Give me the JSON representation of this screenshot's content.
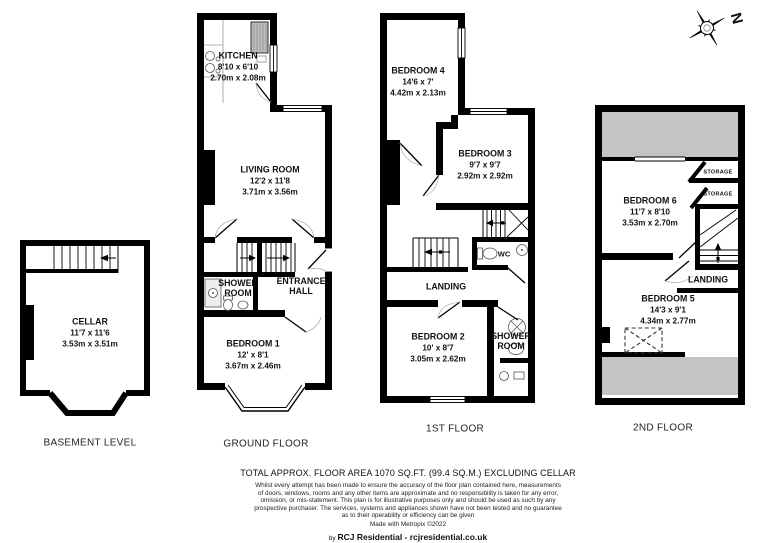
{
  "compass": {
    "label": "N"
  },
  "colors": {
    "wall": "#000000",
    "restricted_area": "#c4c4c4",
    "background": "#ffffff"
  },
  "floors": {
    "basement": {
      "label": "BASEMENT LEVEL",
      "cellar": {
        "name": "CELLAR",
        "imperial": "11'7 x 11'6",
        "metric": "3.53m x 3.51m"
      }
    },
    "ground": {
      "label": "GROUND FLOOR",
      "kitchen": {
        "name": "KITCHEN",
        "imperial": "8'10 x 6'10",
        "metric": "2.70m x 2.08m"
      },
      "living_room": {
        "name": "LIVING ROOM",
        "imperial": "12'2 x 11'8",
        "metric": "3.71m x 3.56m"
      },
      "shower_room": {
        "name": "SHOWER ROOM"
      },
      "entrance_hall": {
        "name": "ENTRANCE HALL"
      },
      "bedroom_1": {
        "name": "BEDROOM 1",
        "imperial": "12' x 8'1",
        "metric": "3.67m x 2.46m"
      }
    },
    "first": {
      "label": "1ST FLOOR",
      "bedroom_4": {
        "name": "BEDROOM 4",
        "imperial": "14'6 x 7'",
        "metric": "4.42m x 2.13m"
      },
      "bedroom_3": {
        "name": "BEDROOM 3",
        "imperial": "9'7 x 9'7",
        "metric": "2.92m x 2.92m"
      },
      "wc": {
        "name": "WC"
      },
      "landing": {
        "name": "LANDING"
      },
      "bedroom_2": {
        "name": "BEDROOM 2",
        "imperial": "10' x 8'7",
        "metric": "3.05m x 2.62m"
      },
      "shower_room": {
        "name": "SHOWER ROOM"
      }
    },
    "second": {
      "label": "2ND FLOOR",
      "bedroom_6": {
        "name": "BEDROOM 6",
        "imperial": "11'7 x 8'10",
        "metric": "3.53m x 2.70m"
      },
      "storage_a": {
        "name": "STORAGE"
      },
      "storage_b": {
        "name": "STORAGE"
      },
      "landing": {
        "name": "LANDING"
      },
      "bedroom_5": {
        "name": "BEDROOM 5",
        "imperial": "14'3 x 9'1",
        "metric": "4.34m x 2.77m"
      }
    }
  },
  "footer": {
    "title": "TOTAL APPROX. FLOOR AREA 1070 SQ.FT. (99.4 SQ.M.) EXCLUDING CELLAR",
    "disclaimer_lines": [
      "Whilst every attempt has been made to ensure the accuracy of the floor plan contained here, measurements",
      "of doors, windows, rooms and any other items are approximate and no responsibility is taken for any error,",
      "omission, or mis-statement. This plan is for illustrative purposes only and should be used as such by any",
      "prospective purchaser. The services, systems and appliances shown have not been tested and no guarantee",
      "as to their operability or efficiency can be given"
    ],
    "made_with": "Made with Metropix ©2022",
    "credit_prefix": "by",
    "credit": "RCJ Residential - rcjresidential.co.uk"
  }
}
